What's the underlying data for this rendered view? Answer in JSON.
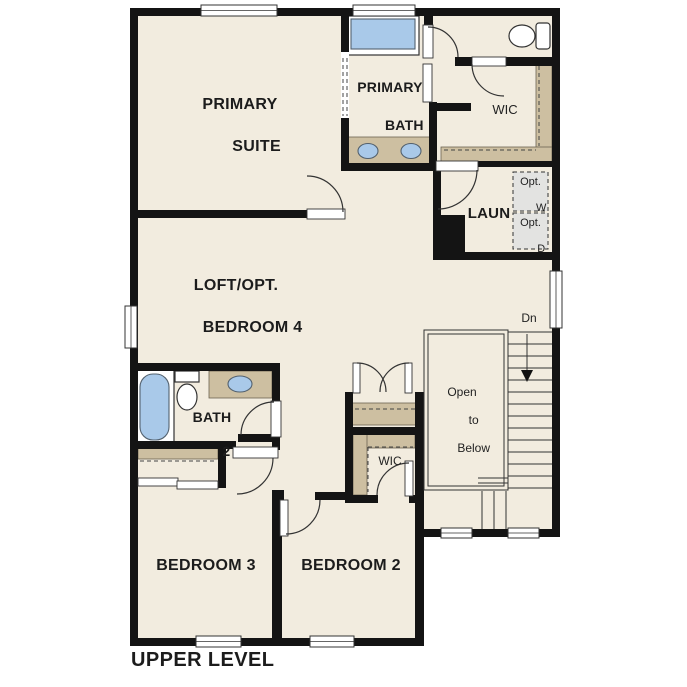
{
  "meta": {
    "view": "residential floor plan, second storey",
    "level_title": "UPPER LEVEL"
  },
  "colors": {
    "floor": "#f2ecdf",
    "wall": "#141414",
    "cabinet": "#cdbfa1",
    "fixture": "#a9c9e9",
    "optional": "#e3e3e1",
    "line": "#333333",
    "text": "#1c1c1c"
  },
  "labels": {
    "primary_suite": {
      "line1": "PRIMARY",
      "line2": "SUITE"
    },
    "primary_bath": {
      "line1": "PRIMARY",
      "line2": "BATH"
    },
    "wic_primary": "WIC",
    "laundry": "LAUN",
    "opt_washer": {
      "line1": "Opt.",
      "line2": "W"
    },
    "opt_dryer": {
      "line1": "Opt.",
      "line2": "D"
    },
    "loft": {
      "line1": "LOFT/OPT.",
      "line2": "BEDROOM 4"
    },
    "stairs_down": "Dn",
    "open_to_below": {
      "line1": "Open",
      "line2": "to",
      "line3": "Below"
    },
    "bath2": {
      "line1": "BATH",
      "line2": "2"
    },
    "wic_bedroom2": "WIC",
    "bedroom3": "BEDROOM 3",
    "bedroom2": "BEDROOM 2",
    "level": "UPPER LEVEL"
  },
  "fixtures": {
    "primary_shower": "shower-icon",
    "primary_toilet": "toilet-icon",
    "primary_vanity": "double-sink-vanity-icon",
    "bath2_tub": "bathtub-icon",
    "bath2_toilet": "toilet-icon",
    "bath2_vanity": "sink-vanity-icon",
    "stairs": "staircase-down",
    "closets": "shelf-and-rod"
  }
}
